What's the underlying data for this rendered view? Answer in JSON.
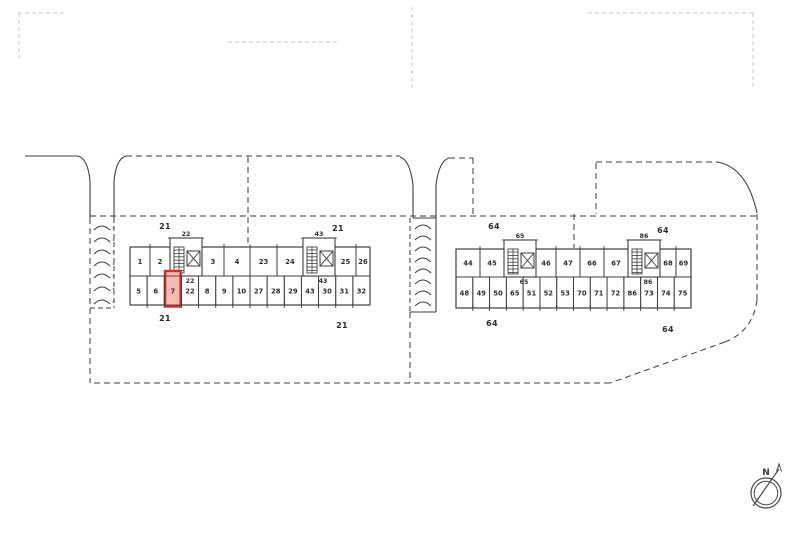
{
  "site_plan": {
    "type": "scanned-site-plan",
    "description": "Cadastral site plan with two apartment blocks of numbered units; unit 7 is highlighted in red",
    "line_color": "#3d3d3d",
    "faint_line_color": "#c9c9c9",
    "highlight": {
      "unit": "7",
      "stroke": "#dd2a1d",
      "fill": "#f6bab4",
      "number_color": "#7c150e"
    },
    "blocks": [
      {
        "id": "block-21",
        "corner_labels": [
          "21",
          "21",
          "21",
          "21"
        ],
        "top_row_cells": [
          "1",
          "2",
          "3",
          "4",
          "23",
          "24",
          "25",
          "26"
        ],
        "bottom_row_cells": [
          "5",
          "6",
          "7",
          "22",
          "8",
          "9",
          "10",
          "27",
          "28",
          "29",
          "43",
          "30",
          "31",
          "32"
        ],
        "cores": [
          {
            "top_label": "22",
            "bottom_label": "22"
          },
          {
            "top_label": "43",
            "bottom_label": "43"
          }
        ]
      },
      {
        "id": "block-64",
        "corner_labels": [
          "64",
          "64",
          "64",
          "64"
        ],
        "top_row_cells": [
          "44",
          "45",
          "46",
          "47",
          "66",
          "67",
          "68",
          "69"
        ],
        "bottom_row_cells": [
          "48",
          "49",
          "50",
          "65",
          "51",
          "52",
          "53",
          "70",
          "71",
          "72",
          "86",
          "73",
          "74",
          "75"
        ],
        "cores": [
          {
            "top_label": "65",
            "bottom_label": "65"
          },
          {
            "top_label": "86",
            "bottom_label": "86"
          }
        ]
      }
    ],
    "compass": {
      "label": "N"
    }
  }
}
